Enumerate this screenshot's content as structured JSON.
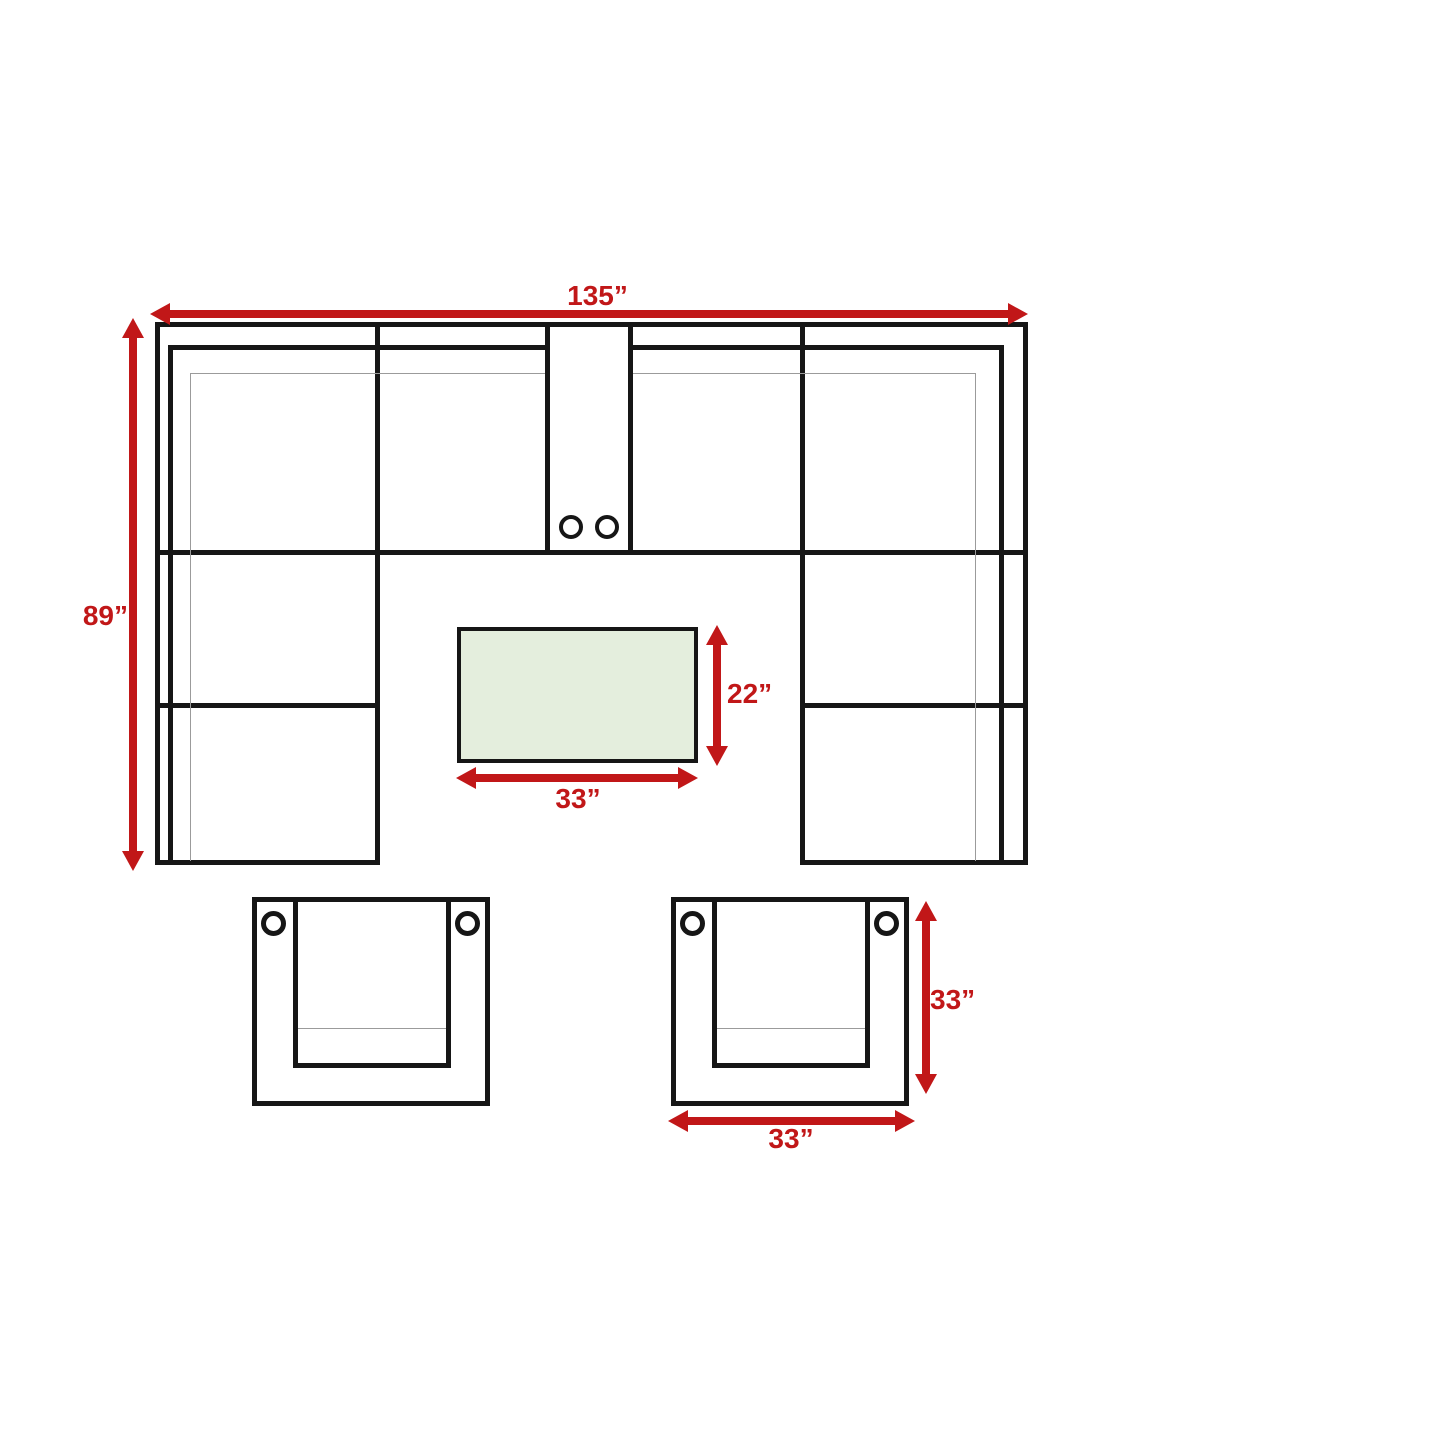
{
  "diagram": {
    "kind": "sectional-sofa-dimension-plan",
    "background": "#ffffff",
    "colors": {
      "outline": "#161616",
      "cushion_line": "#9b9b9b",
      "dimension_red": "#c11718",
      "table_fill": "#e4eedd"
    },
    "sectional": {
      "width_label": "135”",
      "depth_label": "89”"
    },
    "coffee_table": {
      "depth_label": "22”",
      "width_label": "33”"
    },
    "club_chair": {
      "depth_label": "33”",
      "width_label": "33”"
    }
  }
}
